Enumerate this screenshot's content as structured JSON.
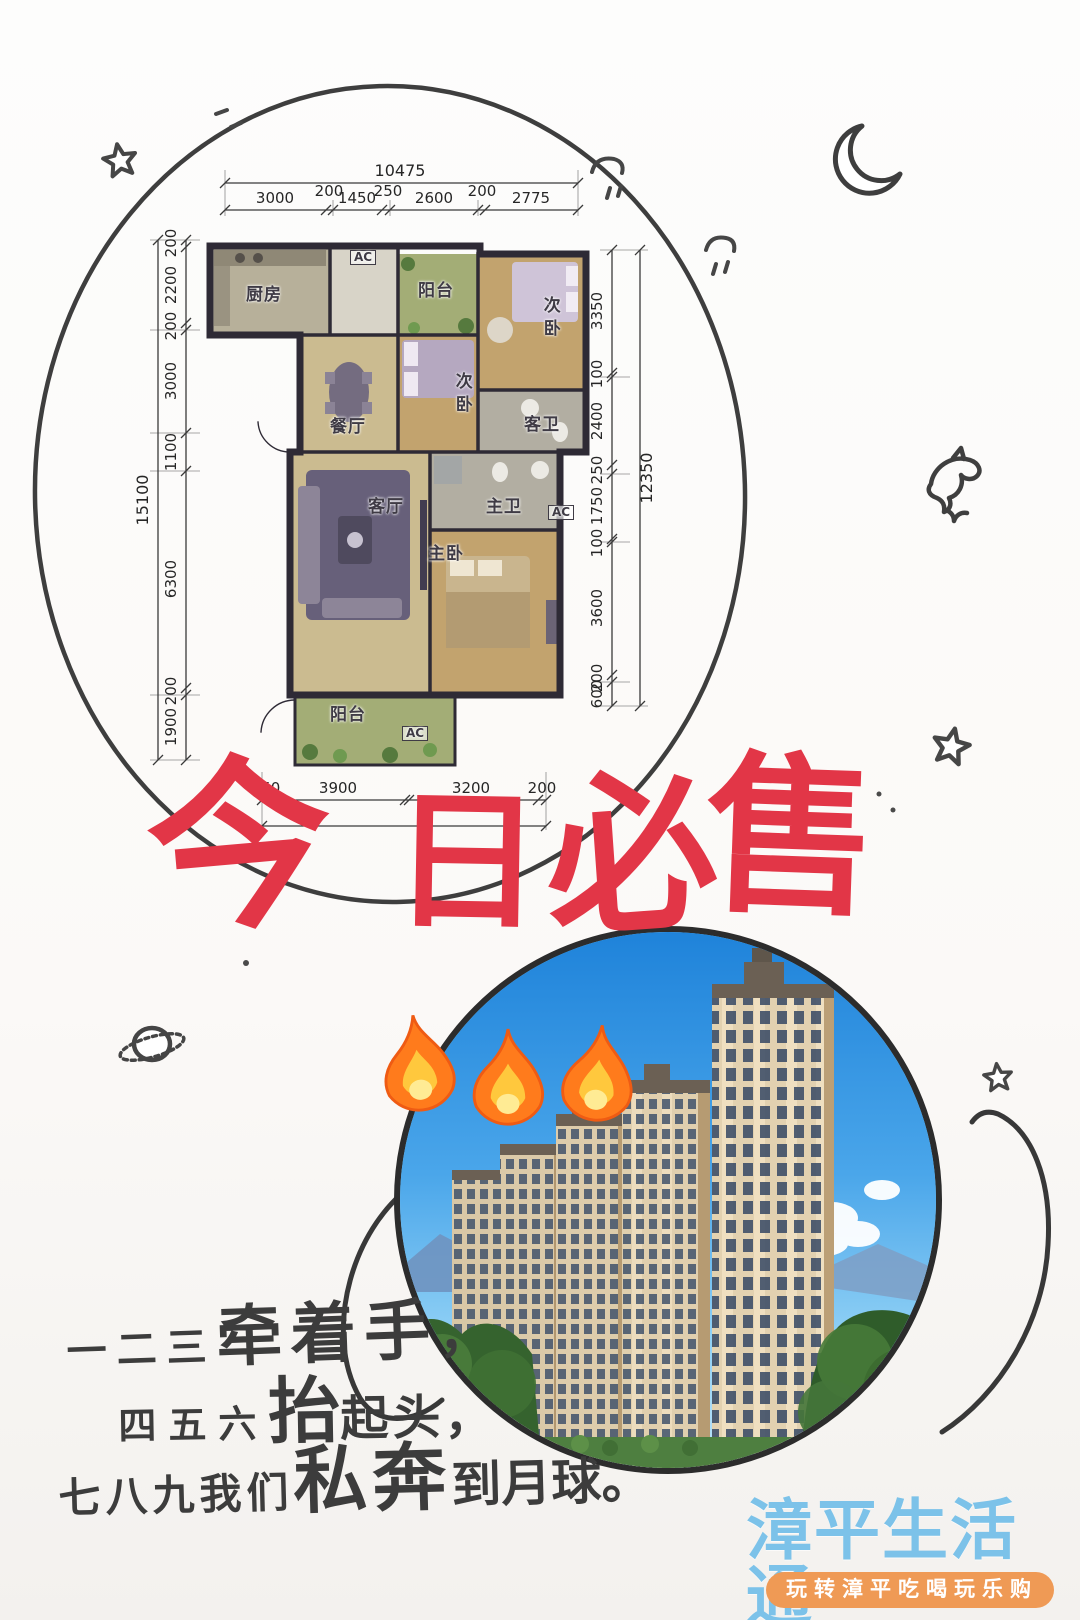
{
  "headline": {
    "text": "今日必售",
    "chars": [
      "今",
      "日",
      "必",
      "售"
    ],
    "color": "#e23647"
  },
  "floorplan": {
    "dims": {
      "top_total": "10475",
      "top": [
        "3000",
        "200",
        "1450",
        "250",
        "2600",
        "200",
        "2775"
      ],
      "left_total": "15100",
      "left": [
        "200",
        "2200",
        "200",
        "3000",
        "1100",
        "6300",
        "200",
        "1900"
      ],
      "right_total": "12350",
      "right": [
        "3350",
        "100",
        "2400",
        "250",
        "1750",
        "100",
        "3600",
        "200",
        "600"
      ],
      "bottom": [
        "250",
        "3900",
        "3200",
        "200"
      ]
    },
    "rooms": [
      {
        "label": "厨房"
      },
      {
        "label": "AC"
      },
      {
        "label": "阳台"
      },
      {
        "label": "次卧"
      },
      {
        "label": "餐厅"
      },
      {
        "label": "次卧"
      },
      {
        "label": "客卫"
      },
      {
        "label": "客厅"
      },
      {
        "label": "主卫"
      },
      {
        "label": "AC"
      },
      {
        "label": "主卧"
      },
      {
        "label": "阳台"
      },
      {
        "label": "AC"
      }
    ]
  },
  "slogan": {
    "line1": {
      "pre": "一二三",
      "emph": "牵着手",
      "suf": "，"
    },
    "line2": {
      "pre": "四五六",
      "emph": "抬",
      "suf": "起头，"
    },
    "line3": {
      "pre": "七八九我们",
      "emph": "私奔",
      "suf": "到月球。"
    }
  },
  "watermark": {
    "brand": "漳平生活通",
    "tagline": "玩转漳平吃喝玩乐购",
    "brand_color": "#7cc2e9",
    "pill_color": "#ef9a55"
  },
  "icons": {
    "fire": "🔥",
    "moon": "🌙",
    "star": "⭐",
    "dolphin": "🐬",
    "planet": "🪐"
  },
  "colors": {
    "ink": "#3e3e3e",
    "headline_red": "#e23647",
    "sky_blue": "#2f8fe0",
    "tile_tan": "#cbbb90",
    "wood": "#c2a36e",
    "balcony_green": "#a3ad76",
    "wall": "#2e2a35"
  }
}
